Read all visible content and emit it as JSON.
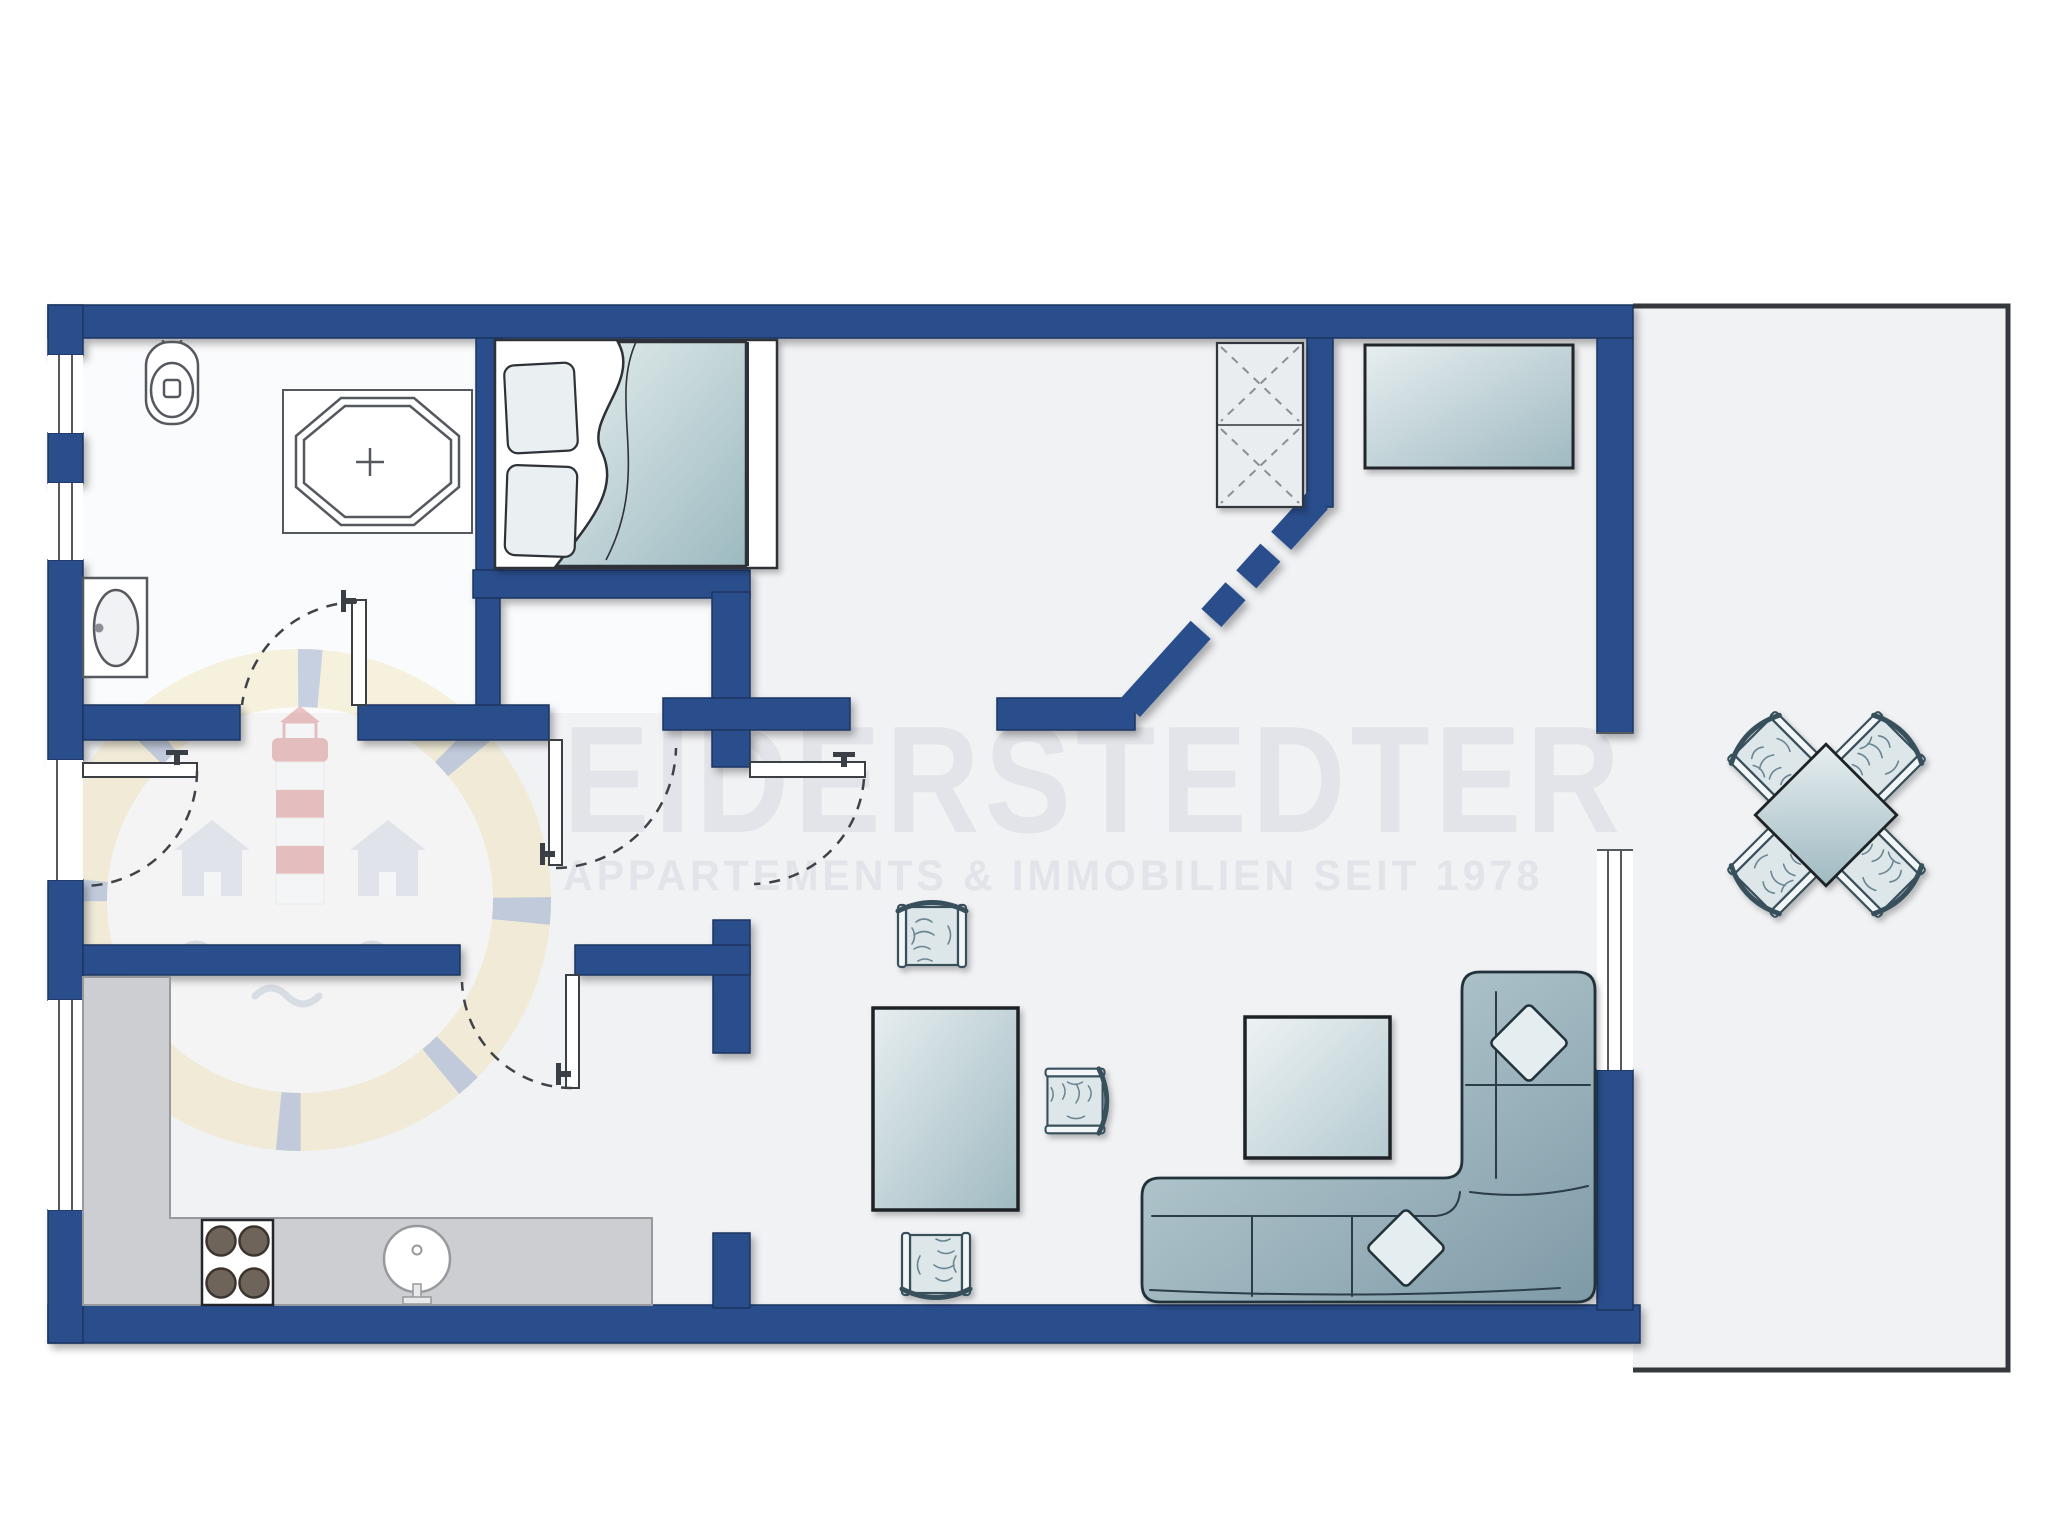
{
  "meta": {
    "kind": "apartment-floor-plan",
    "orientation": "landscape"
  },
  "watermark": {
    "title": "EIDERSTEDTER",
    "subtitle": "APPARTEMENTS & IMMOBILIEN SEIT 1978"
  },
  "colors": {
    "wall": "#2b4d8c",
    "wall_outline": "#1d3560",
    "floor": "#f1f2f4",
    "floor_bath": "#fafbfc",
    "terrace_line": "#35383c",
    "counter": "#cdced1",
    "burner": "#6f6459",
    "watermark_text": "#e2e4e9",
    "logo_ring": "#eed98f",
    "logo_red": "#c33a36",
    "furniture_blue_light": "#e3ecee",
    "furniture_blue_mid": "#a3bec5",
    "sofa_blue": "#8aa4b0"
  },
  "counts": {
    "stove_burners": 4,
    "dining_chairs": 4,
    "terrace_chairs": 4,
    "bed_pillows": 2,
    "sofa_pillows": 2,
    "left_wall_windows": 3,
    "right_wall_windows": 1,
    "doors_with_swing_arcs": 5
  },
  "rooms": {
    "bathroom": {
      "fixtures": [
        "toilet",
        "corner-shower",
        "washbasin"
      ]
    },
    "bedroom": {
      "furniture": [
        "double-bed",
        "wardrobe-closet"
      ]
    },
    "storage_room": {
      "furniture": [
        "cabinet"
      ]
    },
    "kitchen": {
      "fixtures": [
        "l-shaped-counter",
        "stove",
        "round-sink"
      ]
    },
    "living_room": {
      "furniture": [
        "dining-table",
        "dining-chairs",
        "side-table",
        "corner-sofa",
        "stool-chair"
      ]
    },
    "terrace": {
      "furniture": [
        "square-table-diagonal",
        "four-chairs"
      ]
    }
  }
}
